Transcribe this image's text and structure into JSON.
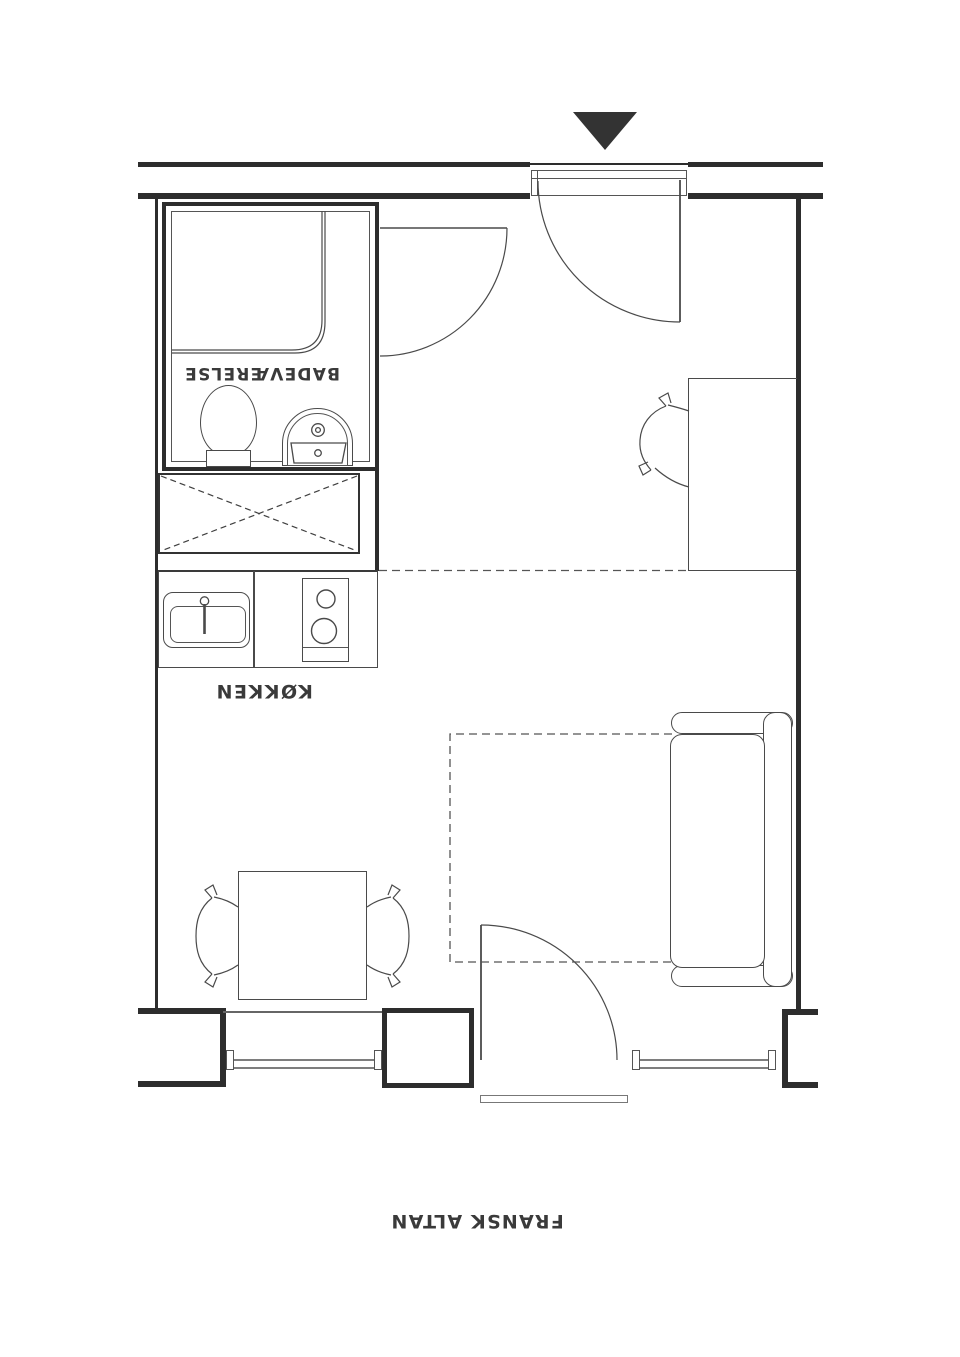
{
  "meta": {
    "type": "apartment-floor-plan",
    "note": "studio floor plan drawn rotated 180 degrees (labels upside down)"
  },
  "labels": {
    "bathroom": "BADEVÆRELSE",
    "kitchen": "KØKKEN",
    "balcony": "FRANSK ALTAN"
  },
  "symbols": {
    "entrance_marker": "filled-triangle-down"
  },
  "fixtures": [
    "entry-door",
    "bathroom-door",
    "balcony-door",
    "shower",
    "toilet",
    "washbasin",
    "wardrobe-crossed-box",
    "kitchen-sink",
    "cooktop",
    "dining-table",
    "dining-chair-left",
    "dining-chair-right",
    "desk",
    "desk-chair",
    "sofa-bed",
    "fold-out-bed-dashed-outline",
    "window-left",
    "window-right",
    "balcony-threshold"
  ],
  "colors": {
    "background": "#ffffff",
    "wall": "#2d2d2d",
    "line": "#4a4a4a",
    "thin_line": "#7e7e7e",
    "marker": "#333333",
    "text": "#3a3a3a"
  }
}
